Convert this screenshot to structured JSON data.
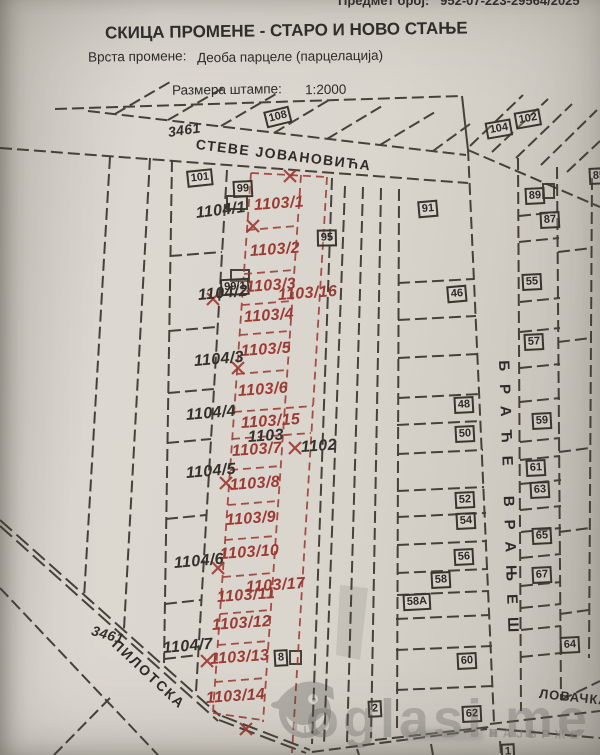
{
  "header": {
    "predmet_label": "Предмет број:",
    "predmet_value": "952-07-223-29564/2025",
    "title": "СКИЦА ПРОМЕНЕ - СТАРО И НОВО СТАЊЕ",
    "vrsta_label": "Врста промене:",
    "vrsta_value": "Деоба парцеле (парцелација)",
    "razmera_label": "Размера штампе:",
    "razmera_value": "1:2000"
  },
  "map": {
    "streets": {
      "steve": "СТЕВЕ ЈОВАНОВИЋА",
      "brace": "БРАЋЕ ВРАЊЕШ",
      "pilotska": "ПИЛОТСКА",
      "lovacka": "ЛОВАЧКА"
    },
    "road_numbers": {
      "top": "3461",
      "bottom": "3461"
    },
    "new_parcels": {
      "p1": "1103/1",
      "p2": "1103/2",
      "p3": "1103/3",
      "p4": "1103/4",
      "p5": "1103/5",
      "p6": "1103/6",
      "p7": "1103/7",
      "p8": "1103/8",
      "p9": "1103/9",
      "p10": "1103/10",
      "p11": "1103/11",
      "p12": "1103/12",
      "p13": "1103/13",
      "p14": "1103/14",
      "p15": "1103/15",
      "p16": "1103/16",
      "p17": "1103/17"
    },
    "old_parcels": {
      "o1": "1104/1",
      "o2": "1104/2",
      "o3": "1104/3",
      "o4": "1104/4",
      "o5": "1104/5",
      "o6": "1104/6",
      "o7": "1104/7",
      "parent": "1103",
      "neighbor": "1102"
    },
    "house_number_boxes": {
      "n108": "108",
      "n104": "104",
      "n102": "102",
      "n101": "101",
      "n99": "99",
      "n99_1": "99/1",
      "n95": "95",
      "n91": "91",
      "n89": "89",
      "n87": "87",
      "n85": "85",
      "n46": "46",
      "n55": "55",
      "n57": "57",
      "n48": "48",
      "n50": "50",
      "n59": "59",
      "n61": "61",
      "n63": "63",
      "n52": "52",
      "n54": "54",
      "n65": "65",
      "n56": "56",
      "n67": "67",
      "n58": "58",
      "n58A": "58A",
      "n64": "64",
      "n60": "60",
      "n62": "62",
      "n8": "8",
      "n2": "2",
      "n1": "1"
    },
    "ink_colors": {
      "black_ink": "#3a362e",
      "red_ink": "#9c3a33"
    }
  },
  "watermark": {
    "brand": "oglasi.me",
    "tagline": "НАЈБРЖЕ"
  }
}
